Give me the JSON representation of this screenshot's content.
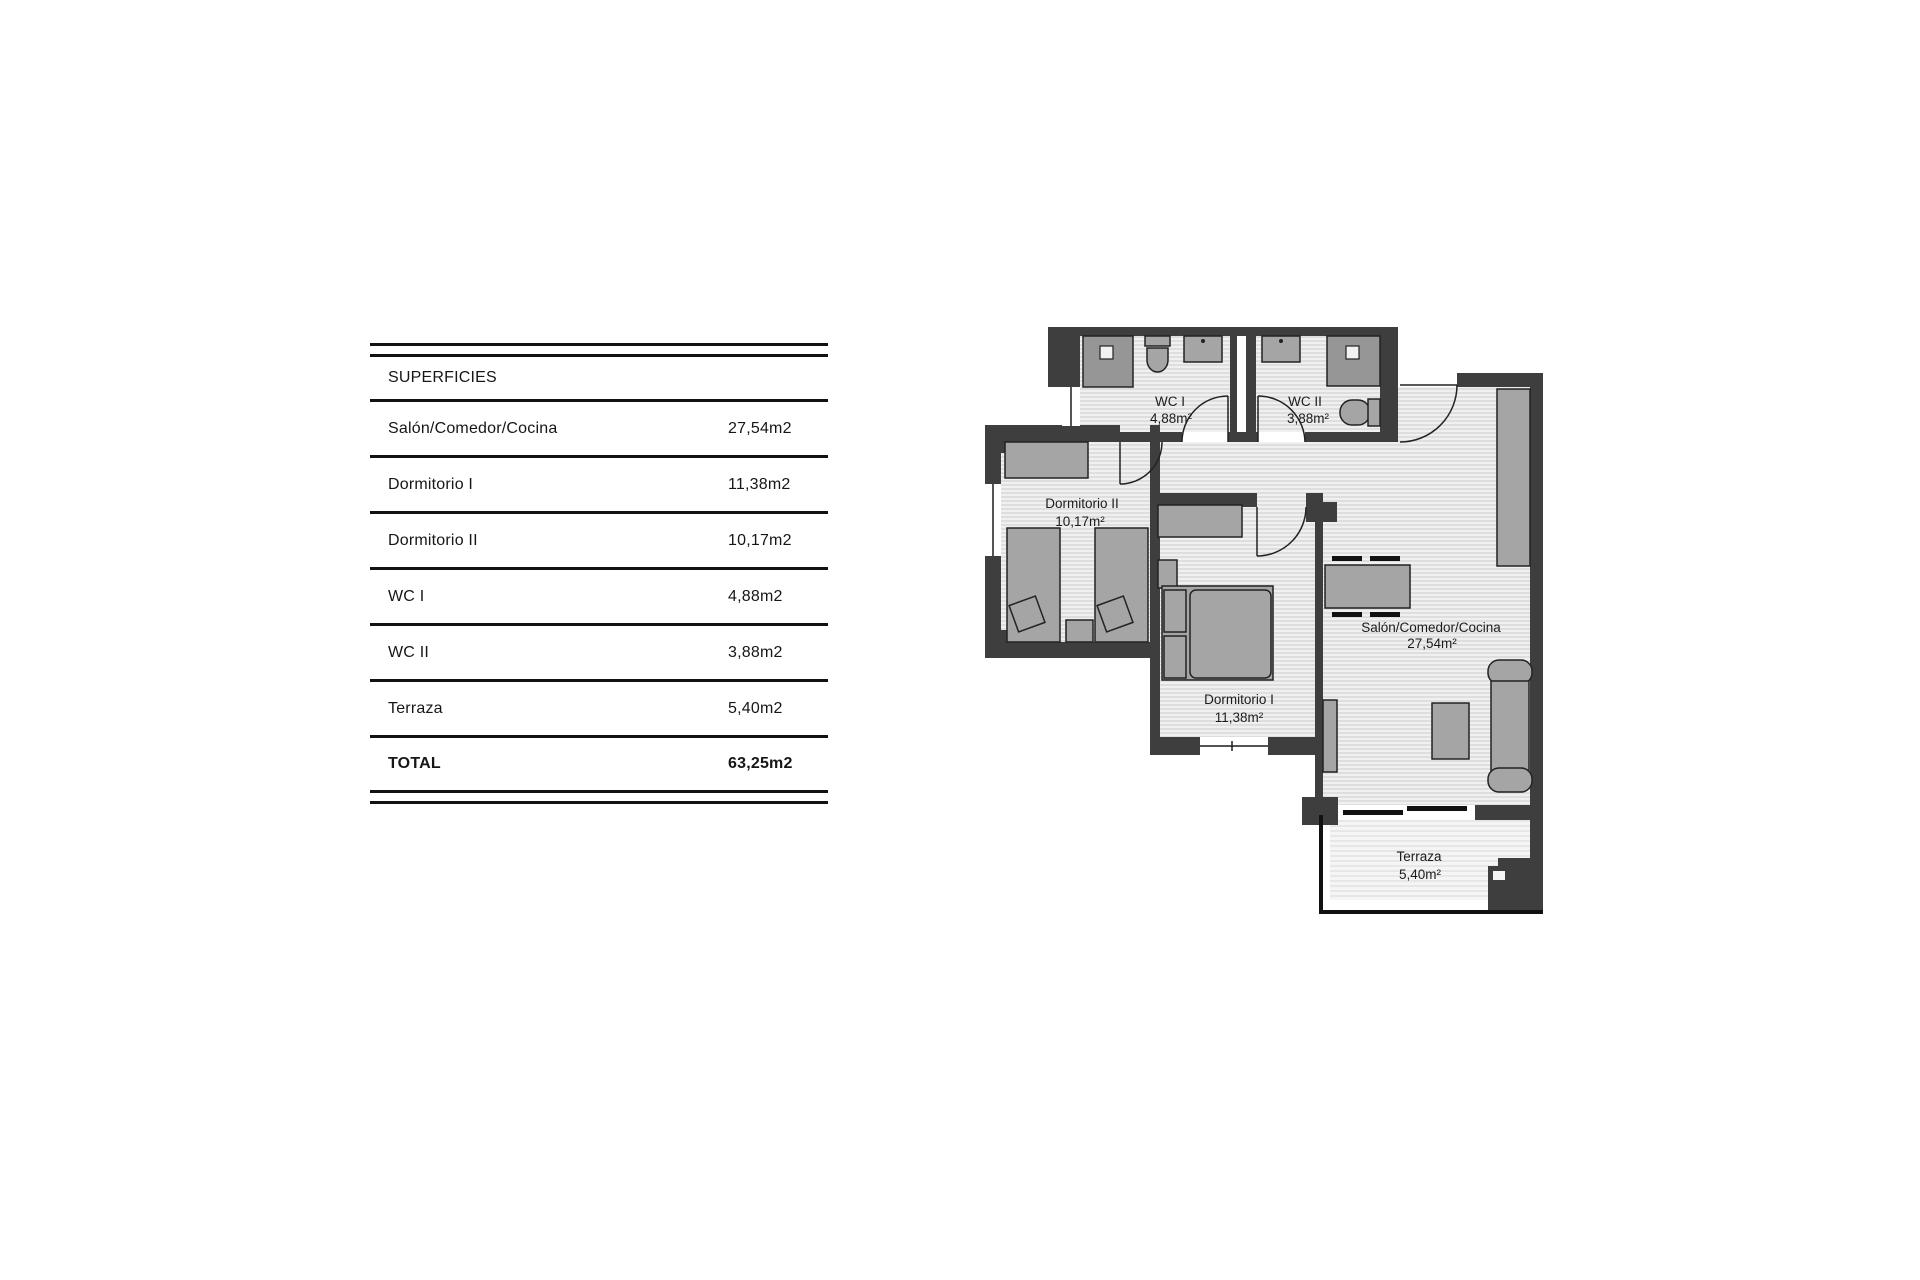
{
  "surfaces_table": {
    "title": "SUPERFICIES",
    "rows": [
      {
        "label": "Salón/Comedor/Cocina",
        "value": "27,54m2"
      },
      {
        "label": "Dormitorio I",
        "value": "11,38m2"
      },
      {
        "label": "Dormitorio II",
        "value": "10,17m2"
      },
      {
        "label": "WC I",
        "value": "4,88m2"
      },
      {
        "label": "WC II",
        "value": "3,88m2"
      },
      {
        "label": "Terraza",
        "value": "5,40m2"
      }
    ],
    "total": {
      "label": "TOTAL",
      "value": "63,25m2"
    }
  },
  "floor_plan": {
    "rooms": [
      {
        "name": "WC I",
        "area": "4,88m²"
      },
      {
        "name": "WC II",
        "area": "3,88m²"
      },
      {
        "name": "Dormitorio II",
        "area": "10,17m²"
      },
      {
        "name": "Dormitorio I",
        "area": "11,38m²"
      },
      {
        "name": "Salón/Comedor/Cocina",
        "area": "27,54m²"
      },
      {
        "name": "Terraza",
        "area": "5,40m²"
      }
    ],
    "colors": {
      "wall": "#3e3e3e",
      "furniture": "#a5a5a5",
      "fixture": "#969696",
      "hatch_line": "#c9c9c9",
      "hatch_bg": "#f0f0f0",
      "terrace_hatch_line": "#d6d6d6",
      "terrace_hatch_bg": "#f5f5f5",
      "line": "#121212"
    }
  }
}
